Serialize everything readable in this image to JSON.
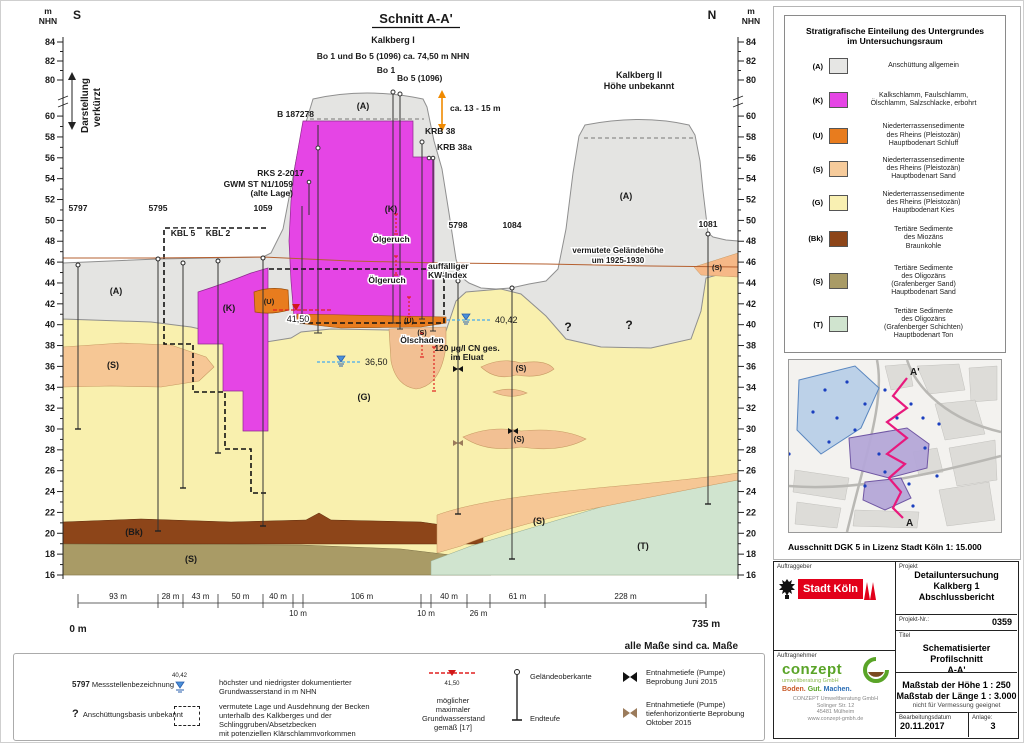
{
  "section": {
    "title": "Schnitt A-A'",
    "dir_south": "S",
    "dir_north": "N",
    "axis_unit_m": "m",
    "axis_unit_nhn": "NHN",
    "shortened_1": "Darstellung",
    "shortened_2": "verkürzt",
    "kalkberg1": "Kalkberg I",
    "bo_note": "Bo 1 und Bo 5 (1096) ca. 74,50 m NHN",
    "kalkberg2_1": "Kalkberg II",
    "kalkberg2_2": "Höhe  unbekannt",
    "height_arrow": "ca. 13 - 15 m",
    "hist_line_1": "vermutete Geländehöhe",
    "hist_line_2": "um 1925-1930",
    "labels": {
      "b187278": "B 187278",
      "rks": "RKS 2-2017",
      "gwm1": "GWM ST N1/1059",
      "gwm2": "(alte Lage)",
      "bo1": "Bo 1",
      "bo5": "Bo 5 (1096)",
      "krb38": "KRB 38",
      "krb38a": "KRB 38a"
    },
    "ann": {
      "oelgeruch": "Ölgeruch",
      "kw1": "auffälliger",
      "kw2": "KW-Index",
      "oelschaden": "Ölschaden",
      "cn1": "120 µg/l CN ges.",
      "cn2": "im Eluat",
      "gw_4042": "40,42",
      "gw_3650": "36,50",
      "gw_4150": "41,50"
    },
    "units": {
      "A": "(A)",
      "K": "(K)",
      "U": "(U)",
      "S": "(S)",
      "G": "(G)",
      "Bk": "(Bk)",
      "T": "(T)"
    },
    "unknown": "?",
    "zero_m": "0 m",
    "total_m": "735 m",
    "measures_note": "alle Maße sind ca. Maße",
    "stations": [
      {
        "label": "5797",
        "x": 77,
        "ly": 210,
        "gok": 264,
        "end": 428
      },
      {
        "label": "5795",
        "x": 157,
        "ly": 210,
        "gok": 258,
        "end": 530
      },
      {
        "label": "KBL 5",
        "x": 182,
        "ly": 235,
        "gok": 262,
        "end": 487
      },
      {
        "label": "KBL 2",
        "x": 217,
        "ly": 235,
        "gok": 260,
        "end": 452
      },
      {
        "label": "1059",
        "x": 262,
        "ly": 210,
        "gok": 257,
        "end": 525
      },
      {
        "label": "5798",
        "x": 457,
        "ly": 227,
        "gok": 280,
        "end": 513
      },
      {
        "label": "1084",
        "x": 511,
        "ly": 227,
        "gok": 287,
        "end": 558
      },
      {
        "label": "1081",
        "x": 707,
        "ly": 226,
        "gok": 233,
        "end": 503
      }
    ],
    "elev_major_low": [
      16,
      18,
      20,
      22,
      24,
      26,
      28,
      30,
      32,
      34,
      36,
      38,
      40,
      42,
      44,
      46,
      48,
      50,
      52,
      54,
      56,
      58,
      60
    ],
    "elev_major_high": [
      80,
      82,
      84
    ],
    "dim_x": [
      77,
      157,
      182,
      217,
      262,
      292,
      302,
      420,
      430,
      466,
      489,
      544,
      705
    ],
    "distances": [
      "93 m",
      "28 m",
      "43 m",
      "50 m",
      "40 m",
      "10 m",
      "106 m",
      "10 m",
      "40 m",
      "26 m",
      "61 m",
      "228 m"
    ],
    "dim_pos": [
      "a",
      "a",
      "a",
      "a",
      "a",
      "b",
      "a",
      "b",
      "a",
      "b",
      "a",
      "a"
    ]
  },
  "legend": {
    "title_1": "Stratigrafische Einteilung des Untergrundes",
    "title_2": "im Untersuchungsraum",
    "items": [
      {
        "code": "(A)",
        "color": "#e6e6e4",
        "lines": [
          "Anschüttung allgemein"
        ]
      },
      {
        "code": "(K)",
        "color": "#e545e5",
        "lines": [
          "Kalkschlamm, Faulschlamm,",
          "Ölschlamm, Salzschlacke, erbohrt"
        ]
      },
      {
        "code": "(U)",
        "color": "#e87c1e",
        "lines": [
          "Niederterrassensedimente",
          "des Rheins (Pleistozän)",
          "Hauptbodenart Schluff"
        ]
      },
      {
        "code": "(S)",
        "color": "#f6cb9b",
        "lines": [
          "Niederterrassensedimente",
          "des Rheins (Pleistozän)",
          "Hauptbodenart Sand"
        ]
      },
      {
        "code": "(G)",
        "color": "#f9f0b2",
        "lines": [
          "Niederterrassensedimente",
          "des Rheins (Pleistozän)",
          "Hauptbodenart Kies"
        ]
      },
      {
        "code": "(Bk)",
        "color": "#8d4519",
        "lines": [
          "Tertiäre Sedimente",
          "des Miozäns",
          "Braunkohle"
        ]
      },
      {
        "code": "(S)",
        "color": "#a99b66",
        "lines": [
          "Tertiäre Sedimente",
          "des Oligozäns",
          "(Grafenberger Sand)",
          "Hauptbodenart Sand"
        ]
      },
      {
        "code": "(T)",
        "color": "#d0e4cf",
        "lines": [
          "Tertiäre Sedimente",
          "des Oligozäns",
          "(Grafenberger Schichten)",
          "Hauptbodenart Ton"
        ]
      }
    ]
  },
  "map": {
    "caption": "Ausschnitt DGK 5 in Lizenz Stadt Köln 1: 15.000",
    "a_start": "A",
    "a_end": "A'"
  },
  "bottom_legend": {
    "station_code": "5797",
    "station_text": "Messstellenbezeichnung",
    "question": "?",
    "question_text": "Anschüttungsbasis unbekannt",
    "gw_value": "40,42",
    "gw_line1": "höchster und niedrigster dokumentierter",
    "gw_line2": "Grundwasserstand in m NHN",
    "becken_1": "vermutete Lage und Ausdehnung der Becken",
    "becken_2": "unterhalb des Kalkberges und der",
    "becken_3": "Schlinggruben/Absetzbecken",
    "becken_4": "mit potenziellen Klärschlammvorkommen",
    "maxgw_value": "41,50",
    "maxgw_1": "möglicher maximaler",
    "maxgw_2": "Grundwasserstand",
    "maxgw_3": "gemäß [17]",
    "gok_label": "Geländeoberkante",
    "endteufe_label": "Endteufe",
    "pump1_1": "Entnahmetiefe (Pumpe)",
    "pump1_2": "Beprobung Juni 2015",
    "pump2_1": "Entnahmetiefe (Pumpe)",
    "pump2_2": "tiefenhorizontierte  Beprobung",
    "pump2_3": "Oktober 2015"
  },
  "titleblock": {
    "auftraggeber_label": "Auftraggeber",
    "client": "Stadt Köln",
    "auftragnehmer_label": "Auftragnehmer",
    "contractor": "conzept",
    "contractor_sub": "umweltberatung GmbH",
    "tagline_1": "Boden.",
    "tagline_2": "Gut.",
    "tagline_3": "Machen.",
    "addr_1": "CONZEPT Umweltberatung GmbH",
    "addr_2": "Solinger Str. 12",
    "addr_3": "45481 Mülheim",
    "addr_4": "www.conzept-gmbh.de",
    "projekt_label": "Projekt",
    "project_1": "Detailuntersuchung",
    "project_2": "Kalkberg 1",
    "project_3": "Abschlussbericht",
    "nr_label": "Projekt-Nr.:",
    "nr": "0359",
    "titel_label": "Titel",
    "title_1": "Schematisierter Profilschnitt",
    "title_2": "A-A'",
    "scale_1": "Maßstab der Höhe 1 : 250",
    "scale_2": "Maßstab der Länge 1 : 3.000",
    "scale_note": "nicht für Vermessung geeignet",
    "date_label": "Bearbeitungsdatum",
    "date": "20.11.2017",
    "anlage_label": "Anlage:",
    "anlage": "3"
  }
}
